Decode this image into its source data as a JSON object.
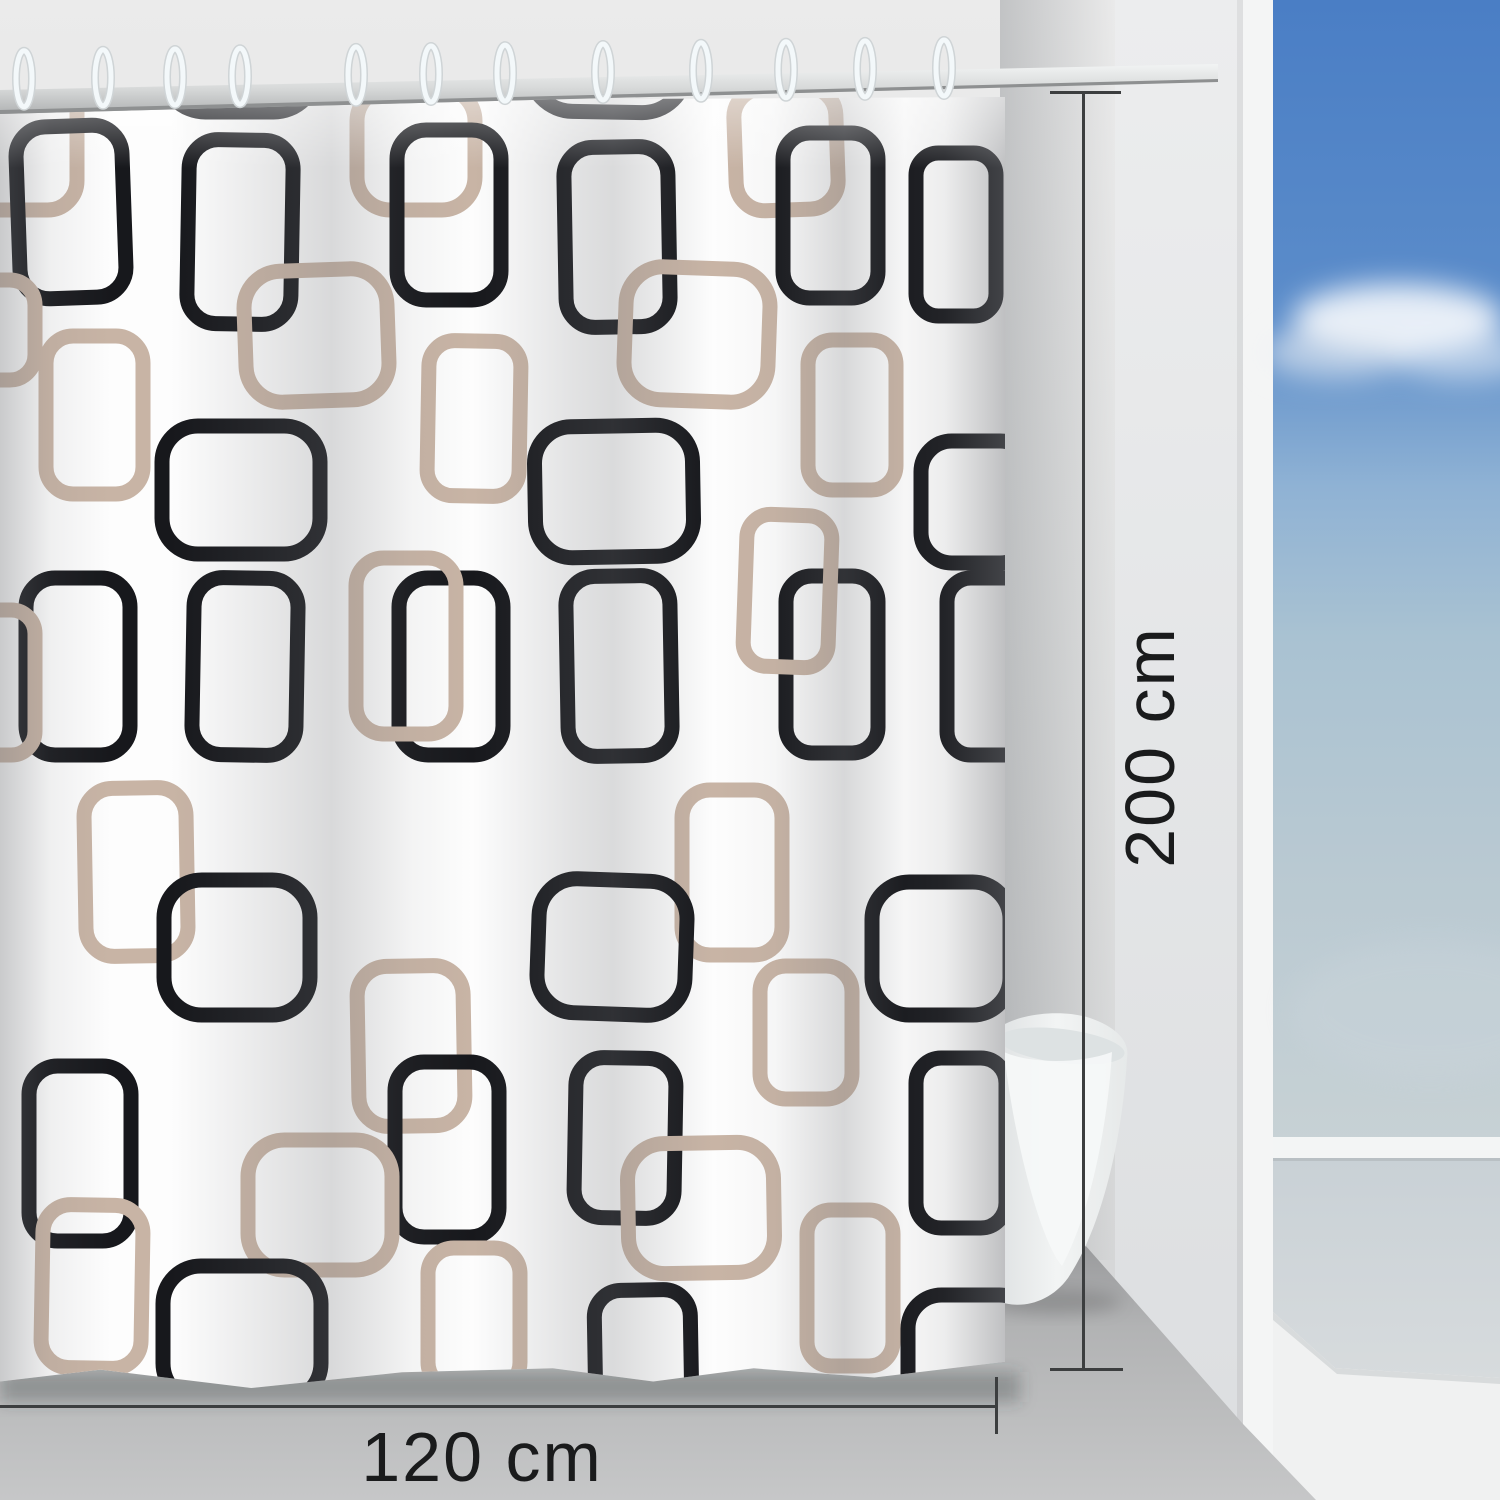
{
  "scene": {
    "description": "Shower curtain with black and taupe retro squares pattern hanging on a chrome rod in a bathroom, with a freestanding bathtub and open view to blue sky",
    "width_px": 1500,
    "height_px": 1500
  },
  "annotations": {
    "height_label": "200 cm",
    "width_label": "120 cm",
    "line_color": "#3c3e3f",
    "text_color": "#1a1b1c"
  },
  "colors": {
    "pattern_black": "#17181c",
    "pattern_tan": "#c8b4a5",
    "curtain_white": "#fdfdfd",
    "wall_gray_top": "#ebebeb",
    "wall_gray_bottom": "#d2d3d4",
    "wall_edge_white": "#f4f5f5",
    "floor_gray_near": "#c6c7c8",
    "floor_gray_far": "#97989a",
    "sky_top": "#4a7ec5",
    "sky_mid": "#8fb2d4",
    "sky_horizon": "#c8d2d5",
    "sill_white": "#f3f5f5",
    "sea_haze": "#ccd3d7",
    "step_white": "#f0f1f1",
    "tub_white": "#eef0f0",
    "ring_white": "#f3f8fa",
    "rod_chrome_light": "#f2f4f4",
    "rod_chrome_dark": "#b0b2b3"
  },
  "curtain": {
    "rings_x": [
      24,
      103,
      175,
      240,
      356,
      431,
      505,
      603,
      701,
      786,
      865,
      944
    ],
    "pattern_note": "entries are [x, y, w, h, colorKey(b=black,t=tan), rotationDeg] in curtain-local px",
    "pattern": [
      [
        -28,
        -16,
        105,
        150,
        "t",
        0
      ],
      [
        162,
        -136,
        155,
        172,
        "b",
        0
      ],
      [
        530,
        -136,
        157,
        172,
        "b",
        1
      ],
      [
        357,
        12,
        118,
        122,
        "t",
        0
      ],
      [
        735,
        12,
        102,
        122,
        "t",
        -2
      ],
      [
        18,
        50,
        106,
        172,
        "b",
        -2
      ],
      [
        188,
        64,
        104,
        184,
        "b",
        1
      ],
      [
        397,
        54,
        104,
        170,
        "b",
        0
      ],
      [
        565,
        71,
        104,
        180,
        "b",
        -1
      ],
      [
        783,
        57,
        95,
        165,
        "b",
        0
      ],
      [
        916,
        77,
        80,
        163,
        "b",
        0
      ],
      [
        245,
        194,
        143,
        131,
        "t",
        -2
      ],
      [
        625,
        192,
        144,
        133,
        "t",
        2
      ],
      [
        -55,
        204,
        90,
        100,
        "t",
        0
      ],
      [
        46,
        260,
        97,
        158,
        "t",
        0
      ],
      [
        428,
        265,
        92,
        155,
        "t",
        1
      ],
      [
        808,
        264,
        88,
        150,
        "t",
        0
      ],
      [
        162,
        350,
        158,
        128,
        "b",
        0
      ],
      [
        535,
        350,
        158,
        131,
        "b",
        -1
      ],
      [
        921,
        365,
        110,
        122,
        "b",
        0
      ],
      [
        26,
        502,
        104,
        177,
        "b",
        0
      ],
      [
        193,
        502,
        104,
        177,
        "b",
        1
      ],
      [
        399,
        502,
        104,
        177,
        "b",
        0
      ],
      [
        567,
        500,
        104,
        180,
        "b",
        -1
      ],
      [
        786,
        500,
        92,
        177,
        "b",
        0
      ],
      [
        947,
        502,
        85,
        177,
        "b",
        0
      ],
      [
        356,
        482,
        100,
        176,
        "t",
        0
      ],
      [
        745,
        439,
        85,
        152,
        "t",
        2
      ],
      [
        -50,
        534,
        85,
        145,
        "t",
        0
      ],
      [
        85,
        712,
        102,
        168,
        "t",
        -1
      ],
      [
        682,
        714,
        100,
        165,
        "t",
        0
      ],
      [
        164,
        804,
        146,
        135,
        "b",
        0
      ],
      [
        538,
        804,
        148,
        134,
        "b",
        2
      ],
      [
        872,
        806,
        138,
        133,
        "b",
        0
      ],
      [
        760,
        890,
        92,
        133,
        "t",
        0
      ],
      [
        358,
        890,
        106,
        160,
        "t",
        -1
      ],
      [
        29,
        990,
        102,
        175,
        "b",
        0
      ],
      [
        395,
        986,
        104,
        175,
        "b",
        0
      ],
      [
        575,
        982,
        100,
        160,
        "b",
        1
      ],
      [
        916,
        982,
        90,
        170,
        "b",
        0
      ],
      [
        628,
        1067,
        146,
        130,
        "t",
        -1
      ],
      [
        248,
        1064,
        144,
        130,
        "t",
        0
      ],
      [
        807,
        1134,
        86,
        156,
        "t",
        0
      ],
      [
        42,
        1129,
        100,
        163,
        "t",
        1
      ],
      [
        428,
        1172,
        92,
        140,
        "t",
        0
      ],
      [
        163,
        1190,
        158,
        135,
        "b",
        0
      ],
      [
        595,
        1214,
        96,
        130,
        "b",
        -1
      ],
      [
        908,
        1219,
        125,
        120,
        "b",
        0
      ]
    ]
  }
}
